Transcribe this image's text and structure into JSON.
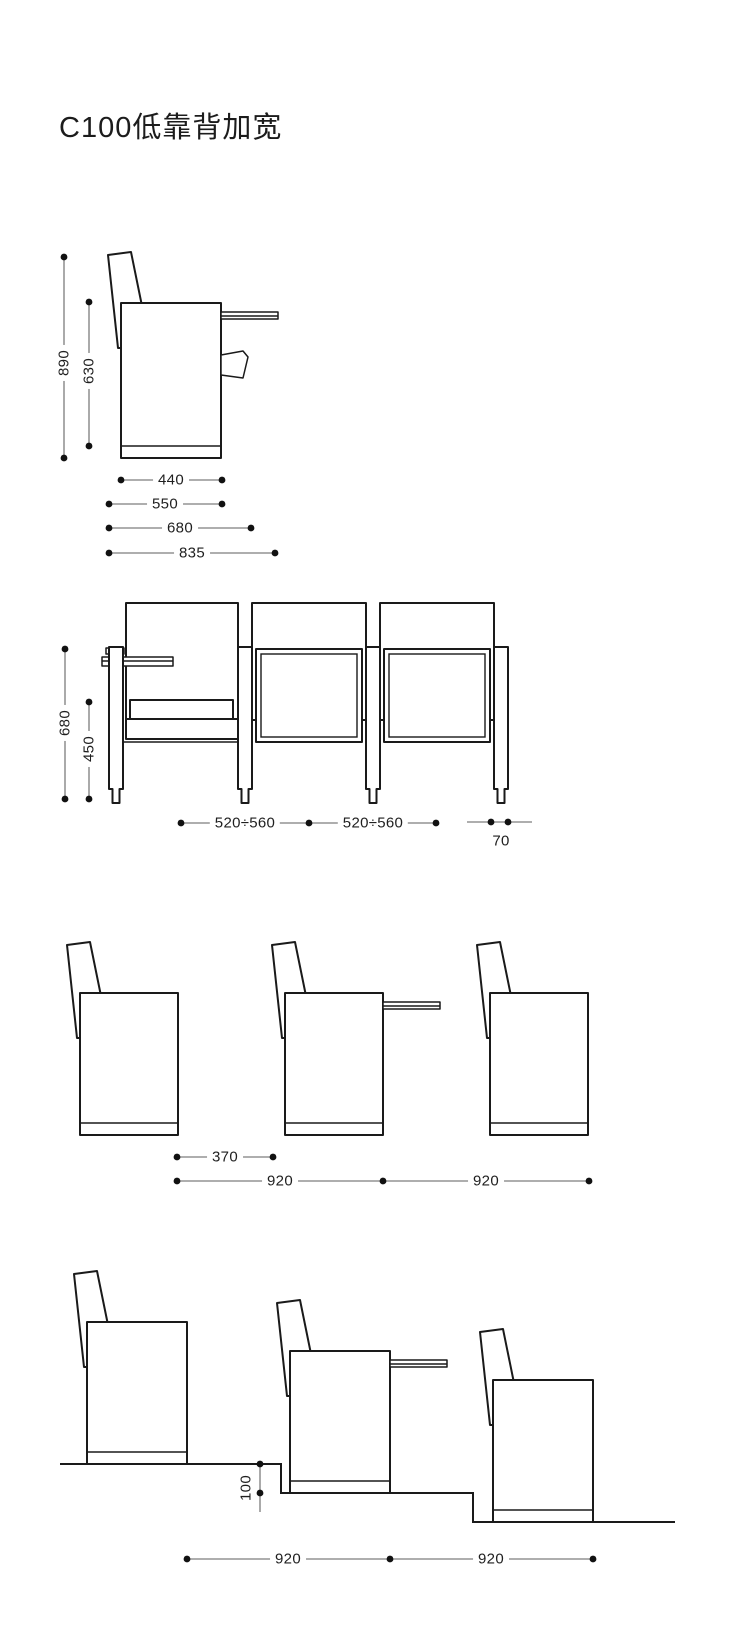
{
  "title": "C100低靠背加宽",
  "colors": {
    "line": "#1a1a1a",
    "dim_line": "#7d7d7d",
    "dot": "#111111",
    "background": "#ffffff"
  },
  "dims": {
    "d1": [
      "890",
      "630",
      "440",
      "550",
      "680",
      "835"
    ],
    "d2": [
      "680",
      "450",
      "520÷560",
      "520÷560",
      "70"
    ],
    "d3": [
      "370",
      "920",
      "920"
    ],
    "d4": [
      "100",
      "920",
      "920"
    ]
  }
}
